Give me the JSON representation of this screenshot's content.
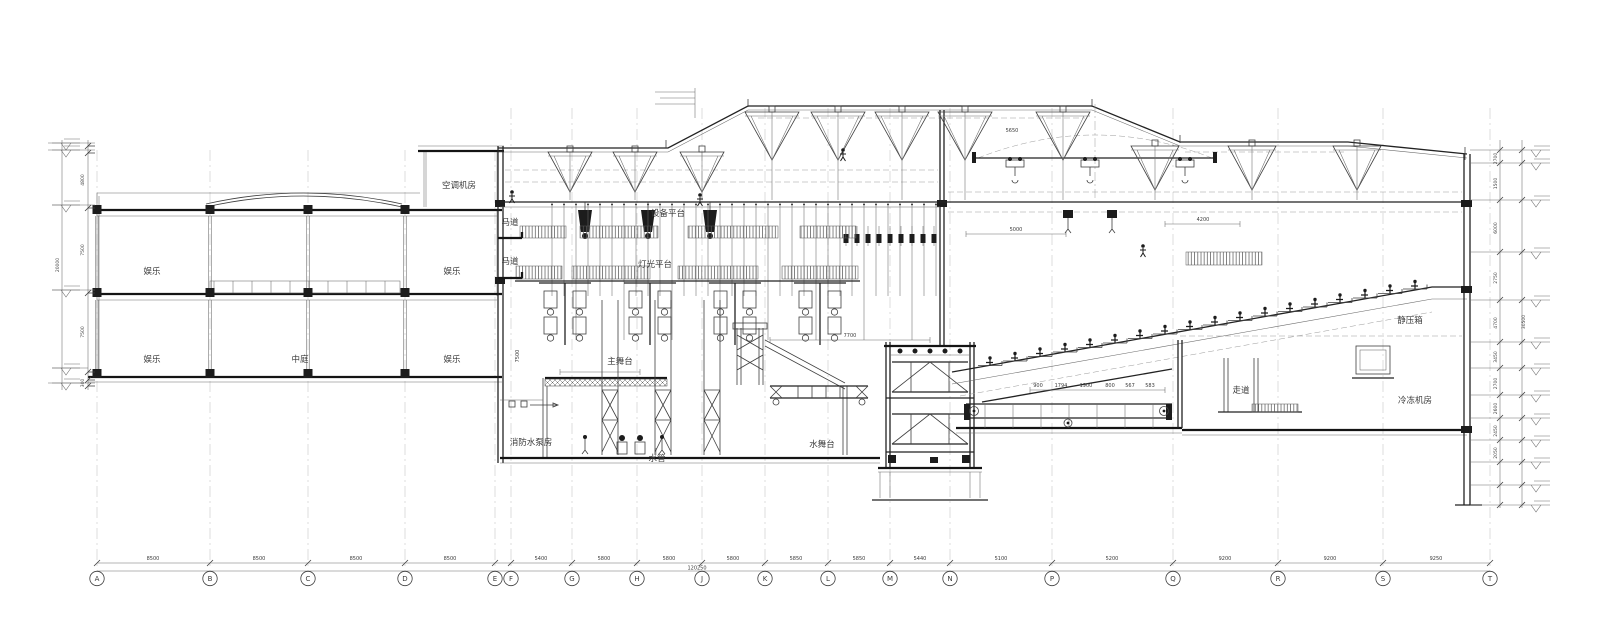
{
  "room_labels": [
    {
      "text": "空调机房",
      "x": 459,
      "y": 188
    },
    {
      "text": "娱乐",
      "x": 152,
      "y": 274
    },
    {
      "text": "娱乐",
      "x": 452,
      "y": 274
    },
    {
      "text": "娱乐",
      "x": 152,
      "y": 362
    },
    {
      "text": "中庭",
      "x": 300,
      "y": 362
    },
    {
      "text": "娱乐",
      "x": 452,
      "y": 362
    },
    {
      "text": "马道",
      "x": 510,
      "y": 225
    },
    {
      "text": "马道",
      "x": 510,
      "y": 264
    },
    {
      "text": "设备平台",
      "x": 668,
      "y": 216
    },
    {
      "text": "灯光平台",
      "x": 655,
      "y": 267
    },
    {
      "text": "主舞台",
      "x": 620,
      "y": 364
    },
    {
      "text": "消防水泵房",
      "x": 531,
      "y": 445
    },
    {
      "text": "水管",
      "x": 657,
      "y": 461
    },
    {
      "text": "水舞台",
      "x": 822,
      "y": 447
    },
    {
      "text": "走道",
      "x": 1241,
      "y": 393
    },
    {
      "text": "静压箱",
      "x": 1410,
      "y": 323
    },
    {
      "text": "冷冻机房",
      "x": 1415,
      "y": 403
    }
  ],
  "annotation_dims": [
    {
      "text": "5000",
      "x": 1016,
      "y": 231,
      "rot": 0
    },
    {
      "text": "4200",
      "x": 1203,
      "y": 221,
      "rot": 0
    },
    {
      "text": "5650",
      "x": 1012,
      "y": 132,
      "rot": 0
    },
    {
      "text": "7700",
      "x": 850,
      "y": 337,
      "rot": 0
    },
    {
      "text": "7500",
      "x": 519,
      "y": 356,
      "rot": -90
    },
    {
      "text": "900",
      "x": 1038,
      "y": 387,
      "rot": 0
    },
    {
      "text": "1794",
      "x": 1061,
      "y": 387,
      "rot": 0
    },
    {
      "text": "1900",
      "x": 1086,
      "y": 387,
      "rot": 0
    },
    {
      "text": "800",
      "x": 1110,
      "y": 387,
      "rot": 0
    },
    {
      "text": "567",
      "x": 1130,
      "y": 387,
      "rot": 0
    },
    {
      "text": "583",
      "x": 1150,
      "y": 387,
      "rot": 0
    }
  ],
  "grid_axes": {
    "letters": [
      "A",
      "B",
      "C",
      "D",
      "E",
      "F",
      "G",
      "H",
      "J",
      "K",
      "L",
      "M",
      "N",
      "P",
      "Q",
      "R",
      "S",
      "T"
    ],
    "x": [
      97,
      210,
      308,
      405,
      495,
      511,
      572,
      637,
      702,
      765,
      828,
      890,
      950,
      1052,
      1173,
      1278,
      1383,
      1490
    ],
    "spacing_labels": [
      {
        "text": "8500",
        "x": 153
      },
      {
        "text": "8500",
        "x": 259
      },
      {
        "text": "8500",
        "x": 356
      },
      {
        "text": "8500",
        "x": 450
      },
      {
        "text": "5400",
        "x": 541
      },
      {
        "text": "5800",
        "x": 604
      },
      {
        "text": "5800",
        "x": 669
      },
      {
        "text": "5800",
        "x": 733
      },
      {
        "text": "5850",
        "x": 796
      },
      {
        "text": "5850",
        "x": 859
      },
      {
        "text": "5440",
        "x": 920
      },
      {
        "text": "5100",
        "x": 1001
      },
      {
        "text": "5200",
        "x": 1112
      },
      {
        "text": "9200",
        "x": 1225
      },
      {
        "text": "9200",
        "x": 1330
      },
      {
        "text": "9250",
        "x": 1436
      }
    ],
    "total_label": {
      "text": "120250",
      "x": 697
    }
  },
  "left_elevation_dims": {
    "values": [
      "4800",
      "7500",
      "7500",
      "300"
    ],
    "total": "20000"
  },
  "right_elevation_dims": {
    "values": [
      "2700",
      "1500",
      "6000",
      "2750",
      "4700",
      "3450",
      "2700",
      "2600",
      "2450",
      "2050"
    ],
    "total": "30500"
  },
  "colors": {
    "line": "#3f3f3f",
    "bold": "#141414",
    "light": "#9a9a9a",
    "background": "#ffffff"
  }
}
